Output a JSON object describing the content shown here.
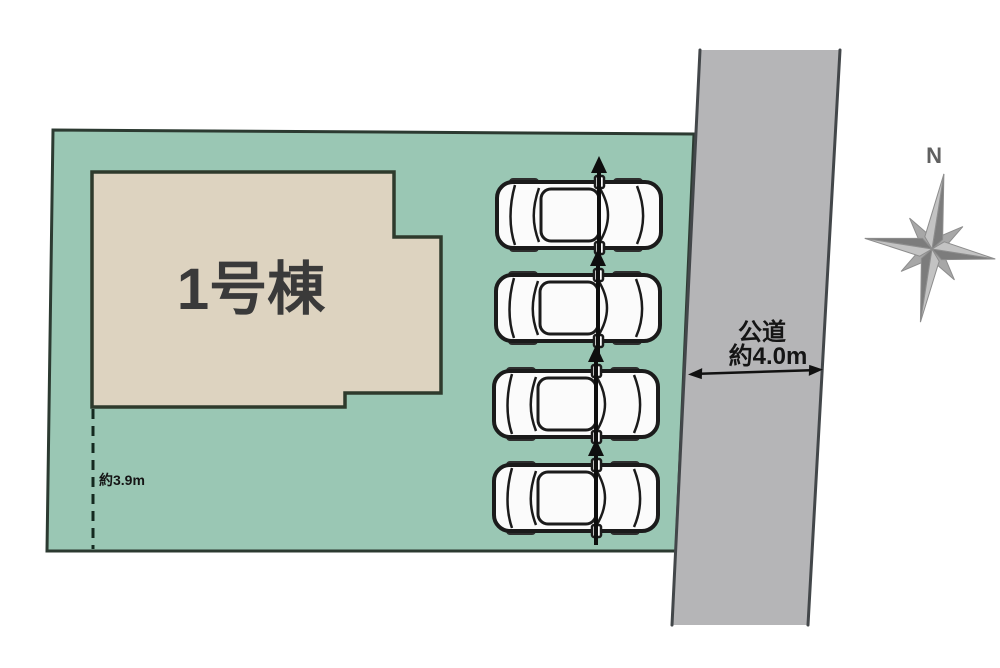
{
  "scene": {
    "kind": "real-estate-site-plan"
  },
  "colors": {
    "background": "#ffffff",
    "plot_fill": "#9ac7b4",
    "building_fill": "#ddd3c0",
    "road_fill": "#b5b5b7",
    "outline_dark": "#1b1b1b",
    "compass_gray": "#8d8d8d"
  },
  "building": {
    "label": "1号棟"
  },
  "setback": {
    "label": "約3.9m"
  },
  "road": {
    "name": "公道",
    "width": "約4.0m"
  },
  "compass": {
    "north_label": "N"
  },
  "parking": {
    "car_count": 4,
    "positions": [
      {
        "transform": "translate(495,178)"
      },
      {
        "transform": "translate(494,271)"
      },
      {
        "transform": "translate(492,367)"
      },
      {
        "transform": "translate(492,461)"
      }
    ]
  }
}
